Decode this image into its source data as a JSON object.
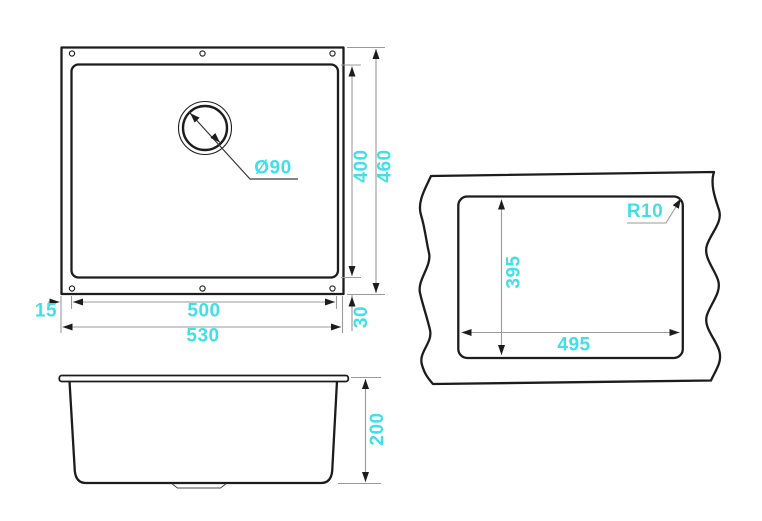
{
  "colors": {
    "dimension_text": "#41dfe8",
    "outline": "#1c1c1c",
    "dimension_lines": "#9a9a9a"
  },
  "dimensions": {
    "plan_drain_diameter": "Ø90",
    "plan_inner_height": "400",
    "plan_outer_height": "460",
    "plan_inner_width": "500",
    "plan_outer_width": "530",
    "plan_rim_left": "15",
    "plan_rim_bottom": "30",
    "cutout_height": "395",
    "cutout_width": "495",
    "cutout_corner_radius": "R10",
    "side_depth": "200"
  }
}
